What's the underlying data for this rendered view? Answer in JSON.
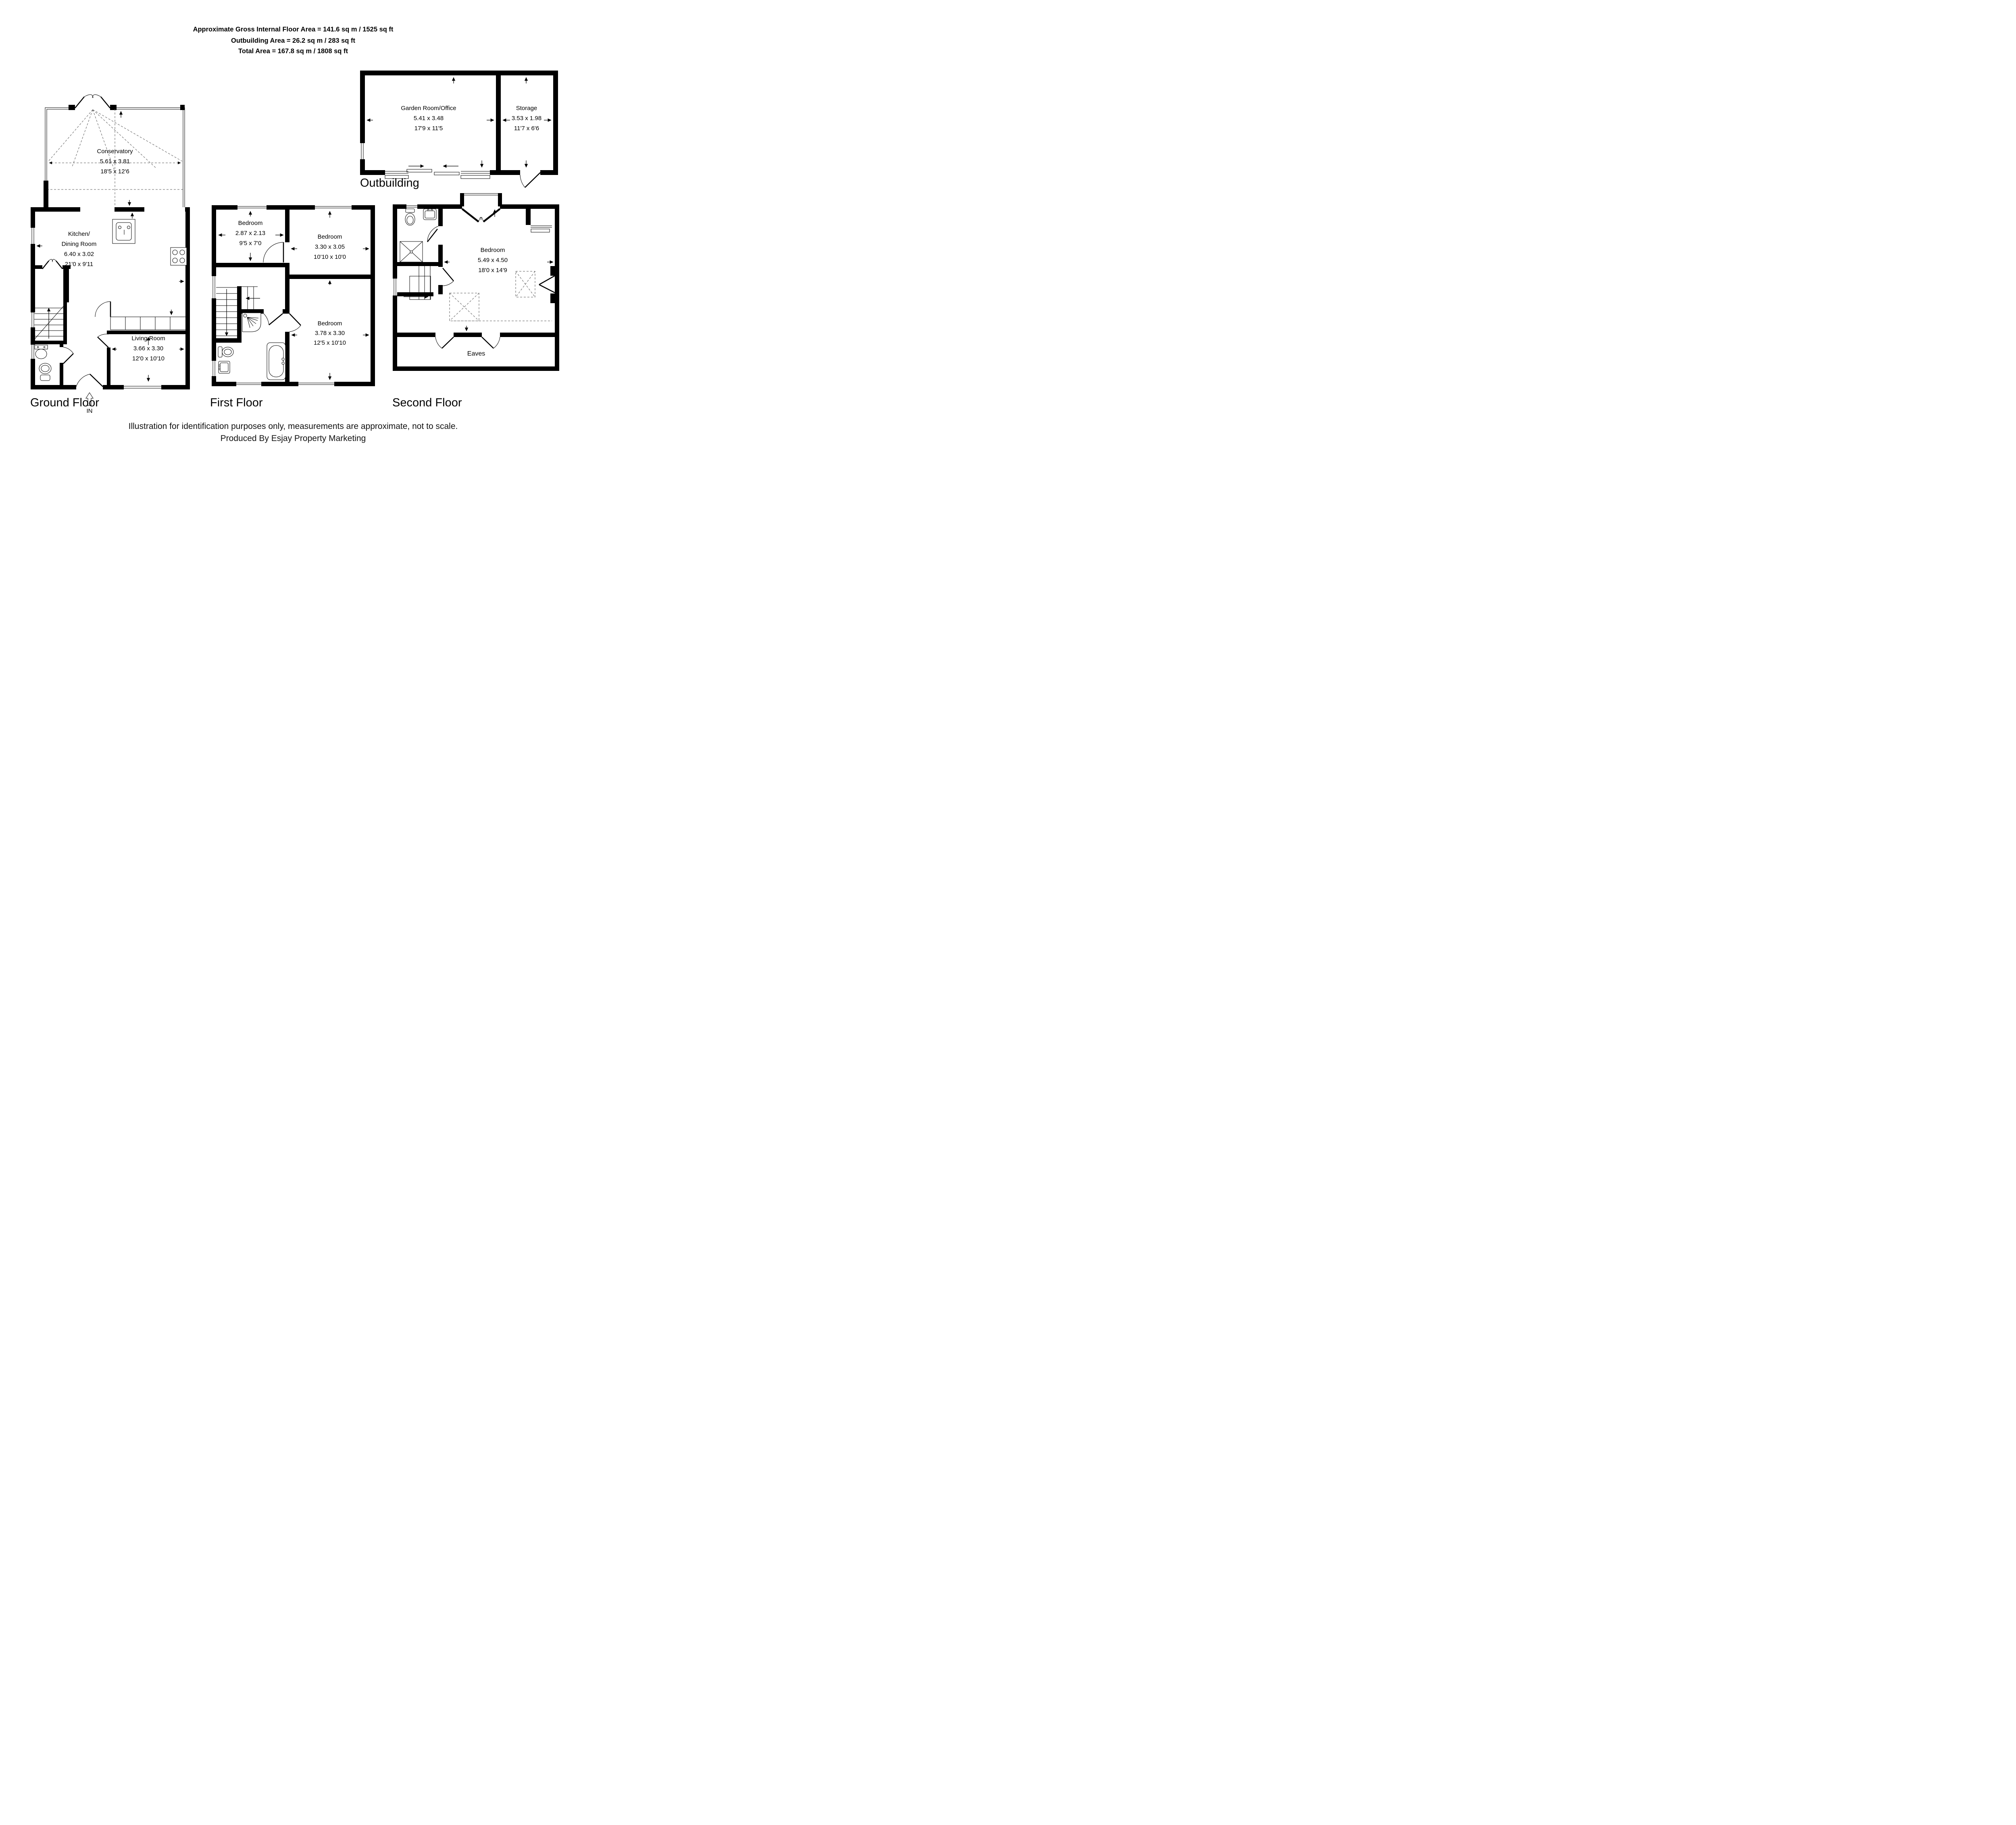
{
  "header": {
    "line1": "Approximate Gross Internal Floor Area = 141.6 sq m / 1525 sq ft",
    "line2": "Outbuilding Area = 26.2 sq m / 283 sq ft",
    "line3": "Total Area = 167.8 sq m / 1808 sq ft"
  },
  "ground_floor": {
    "title": "Ground Floor",
    "entrance_label": "IN",
    "conservatory": {
      "name": "Conservatory",
      "metric": "5.61 x 3.81",
      "imperial": "18'5 x 12'6"
    },
    "kitchen_dining": {
      "name_line1": "Kitchen/",
      "name_line2": "Dining Room",
      "metric": "6.40 x 3.02",
      "imperial": "21'0 x 9'11"
    },
    "living_room": {
      "name": "Living Room",
      "metric": "3.66 x 3.30",
      "imperial": "12'0 x 10'10"
    }
  },
  "first_floor": {
    "title": "First Floor",
    "bedroom_front": {
      "name": "Bedroom",
      "metric": "2.87 x 2.13",
      "imperial": "9'5 x 7'0"
    },
    "bedroom_middle": {
      "name": "Bedroom",
      "metric": "3.30 x 3.05",
      "imperial": "10'10 x 10'0"
    },
    "bedroom_rear": {
      "name": "Bedroom",
      "metric": "3.78 x 3.30",
      "imperial": "12'5 x 10'10"
    }
  },
  "second_floor": {
    "title": "Second Floor",
    "eaves_label": "Eaves",
    "bedroom": {
      "name": "Bedroom",
      "metric": "5.49 x 4.50",
      "imperial": "18'0 x 14'9"
    }
  },
  "outbuilding": {
    "title": "Outbuilding",
    "garden_room": {
      "name": "Garden Room/Office",
      "metric": "5.41 x 3.48",
      "imperial": "17'9 x 11'5"
    },
    "storage": {
      "name": "Storage",
      "metric": "3.53 x 1.98",
      "imperial": "11'7 x 6'6"
    }
  },
  "footer": {
    "line1": "Illustration for identification purposes only, measurements are approximate, not to scale.",
    "line2": "Produced By Esjay Property Marketing"
  },
  "colors": {
    "wall": "#000000",
    "background": "#ffffff",
    "dashed_line": "#555555"
  }
}
